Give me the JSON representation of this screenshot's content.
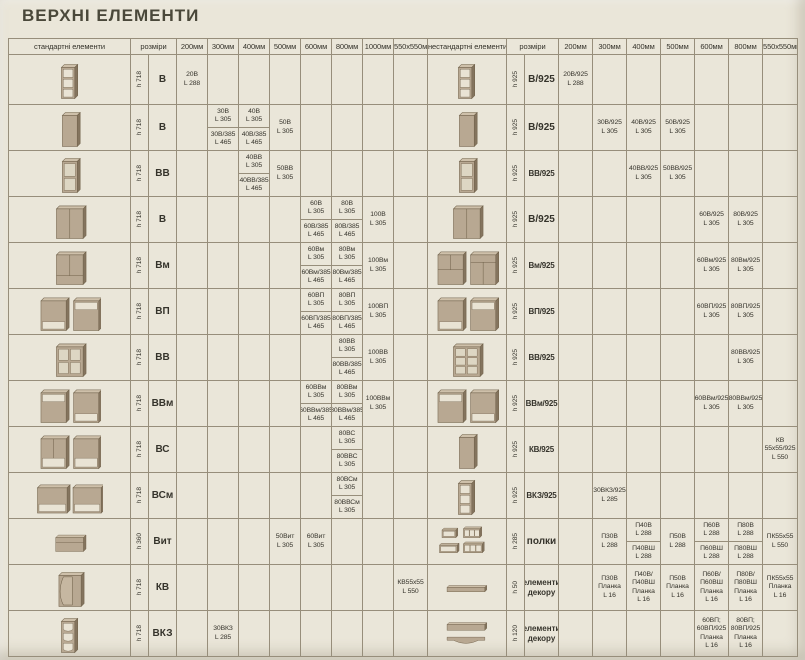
{
  "page": {
    "title": "ВЕРХНІ ЕЛЕМЕНТИ"
  },
  "headers": {
    "left_elements": "стандартні елементи",
    "left_sizes": "розміри",
    "left_cols": [
      "200мм",
      "300мм",
      "400мм",
      "500мм",
      "600мм",
      "800мм",
      "1000мм",
      "550х550мм"
    ],
    "right_elements": "нестандартні елементи",
    "right_sizes": "розміри",
    "right_cols": [
      "200мм",
      "300мм",
      "400мм",
      "500мм",
      "600мм",
      "800мм",
      "550х550мм"
    ]
  },
  "rows": [
    {
      "left": {
        "icon": "wall-shelf-open-3",
        "h": "h 718",
        "code": "В",
        "cells": [
          {
            "top": "20В\nL 288"
          },
          null,
          null,
          null,
          null,
          null,
          null,
          null
        ]
      },
      "right": {
        "icon": "wall-shelf-open-3",
        "h": "h 925",
        "code": "В/925",
        "cells": [
          {
            "top": "20В/925\nL 288"
          },
          null,
          null,
          null,
          null,
          null,
          null
        ]
      }
    },
    {
      "left": {
        "icon": "wall-cabinet-door",
        "h": "h 718",
        "code": "В",
        "cells": [
          null,
          {
            "top": "30В\nL 305",
            "bottom": "30В/385\nL 465"
          },
          {
            "top": "40В\nL 305",
            "bottom": "40В/385\nL 465"
          },
          {
            "top": "50В\nL 305"
          },
          null,
          null,
          null,
          null
        ]
      },
      "right": {
        "icon": "wall-cabinet-door",
        "h": "h 925",
        "code": "В/925",
        "cells": [
          null,
          {
            "top": "30В/925\nL 305"
          },
          {
            "top": "40В/925\nL 305"
          },
          {
            "top": "50В/925\nL 305"
          },
          null,
          null,
          null
        ]
      }
    },
    {
      "left": {
        "icon": "wall-cabinet-glass-2",
        "h": "h 718",
        "code": "ВВ",
        "cells": [
          null,
          null,
          {
            "top": "40ВВ\nL 305",
            "bottom": "40ВВ/385\nL 465"
          },
          {
            "top": "50ВВ\nL 305"
          },
          null,
          null,
          null,
          null
        ]
      },
      "right": {
        "icon": "wall-cabinet-glass-2",
        "h": "h 925",
        "code": "ВВ/925",
        "cells": [
          null,
          null,
          {
            "top": "40ВВ/925\nL 305"
          },
          {
            "top": "50ВВ/925\nL 305"
          },
          null,
          null,
          null
        ]
      }
    },
    {
      "left": {
        "icon": "wall-cabinet-2-door",
        "h": "h 718",
        "code": "В",
        "cells": [
          null,
          null,
          null,
          null,
          {
            "top": "60В\nL 305",
            "bottom": "60В/385\nL 465"
          },
          {
            "top": "80В\nL 305",
            "bottom": "80В/385\nL 465"
          },
          {
            "top": "100В\nL 305"
          },
          null
        ]
      },
      "right": {
        "icon": "wall-cabinet-2-door",
        "h": "h 925",
        "code": "В/925",
        "cells": [
          null,
          null,
          null,
          null,
          {
            "top": "60В/925\nL 305"
          },
          {
            "top": "80В/925\nL 305"
          },
          null
        ]
      }
    },
    {
      "left": {
        "icon": "wall-cabinet-m",
        "h": "h 718",
        "code": "Вм",
        "cells": [
          null,
          null,
          null,
          null,
          {
            "top": "60Вм\nL 305",
            "bottom": "60Вм/385\nL 465"
          },
          {
            "top": "80Вм\nL 305",
            "bottom": "80Вм/385\nL 465"
          },
          {
            "top": "100Вм\nL 305"
          },
          null
        ]
      },
      "right": {
        "icon": "wall-cabinet-pair-m",
        "h": "h 925",
        "code": "Вм/925",
        "cells": [
          null,
          null,
          null,
          null,
          {
            "top": "60Вм/925\nL 305"
          },
          {
            "top": "80Вм/925\nL 305"
          },
          null
        ]
      }
    },
    {
      "left": {
        "icon": "wall-cabinet-pair-niche",
        "h": "h 718",
        "code": "ВП",
        "cells": [
          null,
          null,
          null,
          null,
          {
            "top": "60ВП\nL 305",
            "bottom": "60ВП/385\nL 465"
          },
          {
            "top": "80ВП\nL 305",
            "bottom": "80ВП/385\nL 465"
          },
          {
            "top": "100ВП\nL 305"
          },
          null
        ]
      },
      "right": {
        "icon": "wall-cabinet-pair-niche",
        "h": "h 925",
        "code": "ВП/925",
        "cells": [
          null,
          null,
          null,
          null,
          {
            "top": "60ВП/925\nL 305"
          },
          {
            "top": "80ВП/925\nL 305"
          },
          null
        ]
      }
    },
    {
      "left": {
        "icon": "wall-cabinet-glass-4",
        "h": "h 718",
        "code": "ВВ",
        "cells": [
          null,
          null,
          null,
          null,
          null,
          {
            "top": "80ВВ\nL 305",
            "bottom": "80ВВ/385\nL 465"
          },
          {
            "top": "100ВВ\nL 305"
          },
          null
        ]
      },
      "right": {
        "icon": "wall-cabinet-glass-6",
        "h": "h 925",
        "code": "ВВ/925",
        "cells": [
          null,
          null,
          null,
          null,
          null,
          {
            "top": "80ВВ/925\nL 305"
          },
          null
        ]
      }
    },
    {
      "left": {
        "icon": "wall-cabinet-pair-niche-m",
        "h": "h 718",
        "code": "ВВм",
        "cells": [
          null,
          null,
          null,
          null,
          {
            "top": "60ВВм\nL 305",
            "bottom": "60ВВм/385\nL 465"
          },
          {
            "top": "80ВВм\nL 305",
            "bottom": "80ВВм/385\nL 465"
          },
          {
            "top": "100ВВм\nL 305"
          },
          null
        ]
      },
      "right": {
        "icon": "wall-cabinet-pair-niche-m",
        "h": "h 925",
        "code": "ВВм/925",
        "cells": [
          null,
          null,
          null,
          null,
          {
            "top": "60ВВм/925\nL 305"
          },
          {
            "top": "80ВВм/925\nL 305"
          },
          null
        ]
      }
    },
    {
      "left": {
        "icon": "wall-cabinet-pair-shelf",
        "h": "h 718",
        "code": "ВС",
        "cells": [
          null,
          null,
          null,
          null,
          null,
          {
            "top": "80ВС\nL 305",
            "bottom": "80ВВС\nL 305"
          },
          null,
          null
        ]
      },
      "right": {
        "icon": "wall-cabinet-door",
        "h": "h 925",
        "code": "КВ/925",
        "cells": [
          null,
          null,
          null,
          null,
          null,
          null,
          {
            "top": "КВ\n55х55/925\nL 550"
          }
        ]
      }
    },
    {
      "left": {
        "icon": "wall-cabinet-pair-wide",
        "h": "h 718",
        "code": "ВСм",
        "cells": [
          null,
          null,
          null,
          null,
          null,
          {
            "top": "80ВСм\nL 305",
            "bottom": "80ВВСм\nL 305"
          },
          null,
          null
        ]
      },
      "right": {
        "icon": "wall-shelf-open-3",
        "h": "h 925",
        "code": "ВКЗ/925",
        "cells": [
          null,
          {
            "top": "30ВКЗ/925\nL 285"
          },
          null,
          null,
          null,
          null,
          null
        ]
      }
    },
    {
      "left": {
        "icon": "hood-cabinet",
        "h": "h 360",
        "code": "Вит",
        "cells": [
          null,
          null,
          null,
          {
            "top": "50Вит\nL 305"
          },
          {
            "top": "60Вит\nL 305"
          },
          null,
          null,
          null
        ]
      },
      "right": {
        "icon": "shelves-set",
        "h": "h 285",
        "code": "полки",
        "cells": [
          null,
          {
            "top": "П30В\nL 288"
          },
          {
            "top": "П40В\nL 288",
            "bottom": "П40ВШ\nL 288"
          },
          {
            "top": "П50В\nL 288"
          },
          {
            "top": "П60В\nL 288",
            "bottom": "П60ВШ\nL 288"
          },
          {
            "top": "П80В\nL 288",
            "bottom": "П80ВШ\nL 288"
          },
          {
            "top": "ПК55х55\nL 550"
          }
        ]
      }
    },
    {
      "left": {
        "icon": "corner-cabinet",
        "h": "h 718",
        "code": "КВ",
        "cells": [
          null,
          null,
          null,
          null,
          null,
          null,
          null,
          {
            "top": "КВ55х55\nL 550"
          }
        ]
      },
      "right": {
        "icon": "decor-plank",
        "h": "h 50",
        "code": "елементи\nдекору",
        "cells": [
          null,
          {
            "top": "П30В\nПланка\nL 16"
          },
          {
            "top": "П40В/П40ВШ\nПланка\nL 16"
          },
          {
            "top": "П50В\nПланка\nL 16"
          },
          {
            "top": "П60В/П60ВШ\nПланка\nL 16"
          },
          {
            "top": "П80В/П80ВШ\nПланка\nL 16"
          },
          {
            "top": "ПК55х55\nПланка\nL 16"
          }
        ]
      }
    },
    {
      "left": {
        "icon": "shelf-unit-curved",
        "h": "h 718",
        "code": "ВКЗ",
        "cells": [
          null,
          {
            "top": "30ВКЗ\nL 285"
          },
          null,
          null,
          null,
          null,
          null,
          null
        ]
      },
      "right": {
        "icon": "valance-set",
        "h": "h 120",
        "code": "елементи\nдекору",
        "cells": [
          null,
          null,
          null,
          null,
          {
            "top": "60ВП;\n60ВП/925\nПланка\nL 16"
          },
          {
            "top": "80ВП;\n80ВП/925\nПланка\nL 16"
          },
          null
        ]
      }
    }
  ]
}
